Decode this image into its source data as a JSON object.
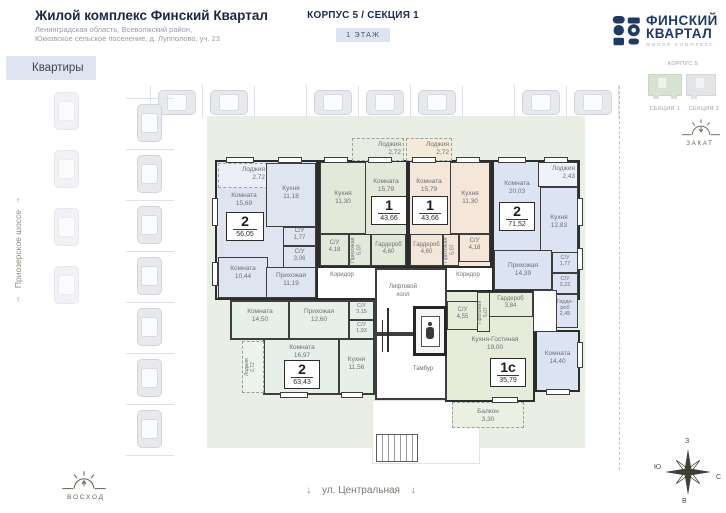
{
  "header": {
    "title": "Жилой комплекс Финский Квартал",
    "address_line1": "Ленинградская область, Всеволжский район,",
    "address_line2": "Юкковское сельское поселение, д. Лупполово, уч. 23",
    "apartments_tab": "Квартиры",
    "corpus_section": "КОРПУС 5 / СЕКЦИЯ 1",
    "floor_label": "1 ЭТАЖ"
  },
  "logo": {
    "name_line1": "ФИНСКИЙ",
    "name_line2": "КВАРТАЛ",
    "tagline": "ЖИЛОЙ КОМПЛЕКС"
  },
  "minimap": {
    "corpus_label": "КОРПУС 5",
    "section1": "СЕКЦИЯ 1",
    "section2": "СЕКЦИЯ 2"
  },
  "orientation": {
    "sunset_label": "ЗАКАТ",
    "sunrise_label": "ВОСХОД",
    "compass": {
      "top": "З",
      "left": "Ю",
      "right": "С",
      "bottom": "В"
    }
  },
  "streets": {
    "left_street": "Приозерское шоссе",
    "bottom_street": "ул. Центральная",
    "up_arrow": "↑",
    "down_arrow": "↓"
  },
  "common": {
    "corridor_left": "Коридор",
    "corridor_right": "Коридор",
    "elevator_hall": "Лифтовой холл",
    "vestibule": "Тамбур"
  },
  "apartments": {
    "a56": {
      "num": "2",
      "area": "56,05",
      "rooms": {
        "loggia": {
          "n": "Лоджия",
          "a": "2,72"
        },
        "room1": {
          "n": "Комната",
          "a": "15,69"
        },
        "kitchen": {
          "n": "Кухня",
          "a": "11,18"
        },
        "su1": {
          "n": "С/У",
          "a": "1,77"
        },
        "su2": {
          "n": "С/У",
          "a": "3,06"
        },
        "room2": {
          "n": "Комната",
          "a": "10,44"
        },
        "hall": {
          "n": "Прихожая",
          "a": "11,19"
        }
      }
    },
    "b43": {
      "num": "1",
      "area": "43,66",
      "rooms": {
        "loggia": {
          "n": "Лоджия",
          "a": "2,72"
        },
        "kitchen": {
          "n": "Кухня",
          "a": "11,30"
        },
        "room1": {
          "n": "Комната",
          "a": "15,79"
        },
        "su1": {
          "n": "С/У",
          "a": "4,18"
        },
        "hall": {
          "n": "Прихожая",
          "a": "5,07"
        },
        "ward": {
          "n": "Гардероб",
          "a": "4,60"
        }
      }
    },
    "c43": {
      "num": "1",
      "area": "43,66",
      "rooms": {
        "loggia": {
          "n": "Лоджия",
          "a": "2,72"
        },
        "room1": {
          "n": "Комната",
          "a": "15,79"
        },
        "kitchen": {
          "n": "Кухня",
          "a": "11,30"
        },
        "ward": {
          "n": "Гардероб",
          "a": "4,60"
        },
        "hall": {
          "n": "Прихожая",
          "a": "5,07"
        },
        "su1": {
          "n": "С/У",
          "a": "4,18"
        }
      }
    },
    "d71": {
      "num": "2",
      "area": "71,52",
      "rooms": {
        "loggia": {
          "n": "Лоджия",
          "a": "2,43"
        },
        "room1": {
          "n": "Комната",
          "a": "20,03"
        },
        "kitchen": {
          "n": "Кухня",
          "a": "12,83"
        },
        "hall": {
          "n": "Прихожая",
          "a": "14,39"
        },
        "su1": {
          "n": "С/У",
          "a": "1,77"
        },
        "su2": {
          "n": "С/У",
          "a": "3,22"
        },
        "ward": {
          "n": "Гарде-роб",
          "a": "2,45"
        },
        "room2": {
          "n": "Комната",
          "a": "14,40"
        }
      }
    },
    "e35": {
      "num": "1с",
      "area": "35,79",
      "rooms": {
        "ward": {
          "n": "Гардероб",
          "a": "3,84"
        },
        "su1": {
          "n": "С/У",
          "a": "4,55"
        },
        "hall": {
          "n": "Прихожая",
          "a": "5,07"
        },
        "living": {
          "n": "Кухня-Гостиная",
          "a": "19,00"
        },
        "balcony": {
          "n": "Балкон",
          "a": "3,30"
        }
      }
    },
    "f63": {
      "num": "2",
      "area": "63,43",
      "rooms": {
        "room1": {
          "n": "Комната",
          "a": "14,50"
        },
        "hall": {
          "n": "Прихожая",
          "a": "12,60"
        },
        "su1": {
          "n": "С/У",
          "a": "3,15"
        },
        "su2": {
          "n": "С/У",
          "a": "1,93"
        },
        "room2": {
          "n": "Комната",
          "a": "16,97"
        },
        "kitchen": {
          "n": "Кухня",
          "a": "11,56"
        },
        "loggia": {
          "n": "Лоджия",
          "a": "2,72"
        }
      }
    }
  },
  "icons": {
    "sunset": "sun-horizon",
    "sunrise": "sun-horizon",
    "compass": "compass-rose",
    "car": "car-top-view",
    "elevator": "elevator-person",
    "logo": "fk-monogram"
  },
  "colors": {
    "brand_navy": "#1d3a6c",
    "tab_bg": "#dfe5f0",
    "lawn": "#e9efe4",
    "wall": "#2e2e2e",
    "apt_2_56_05": "#dfe4f1",
    "apt_1_43_66_left": "#e2e9d9",
    "apt_1_43_66_right": "#f4e6d8",
    "apt_2_71_52": "#dce4f3",
    "apt_1c_35_79": "#e5ecda",
    "apt_2_63_43": "#e6f0e9"
  }
}
